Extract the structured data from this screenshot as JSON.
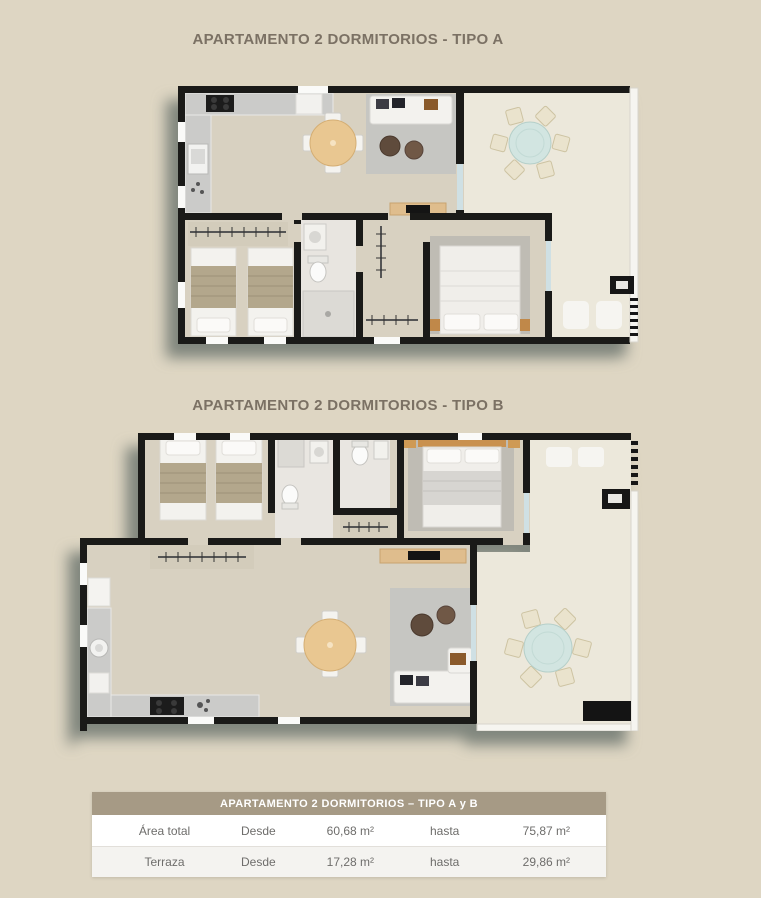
{
  "plan_a": {
    "title": "APARTAMENTO 2 DORMITORIOS - TIPO A"
  },
  "plan_b": {
    "title": "APARTAMENTO 2 DORMITORIOS - TIPO B"
  },
  "summary_table": {
    "header": "APARTAMENTO 2 DORMITORIOS – TIPO A y B",
    "rows": [
      {
        "label": "Área total",
        "desde_label": "Desde",
        "desde_value": "60,68 m²",
        "hasta_label": "hasta",
        "hasta_value": "75,87 m²"
      },
      {
        "label": "Terraza",
        "desde_label": "Desde",
        "desde_value": "17,28 m²",
        "hasta_label": "hasta",
        "hasta_value": "29,86 m²"
      }
    ]
  },
  "colors": {
    "page_background": "#ded6c3",
    "wall": "#1a1a18",
    "interior_floor": "#d8d1c1",
    "terrace_floor": "#ece8db",
    "terrace_table_teal": "#d2e5e1",
    "wood": "#e9c791",
    "rug_gray": "#c6c6c2",
    "table_header_bg": "#a69a85",
    "title_text": "#7b7164",
    "table_text": "#6e6d6b",
    "plan_shadow": "#606b66"
  }
}
